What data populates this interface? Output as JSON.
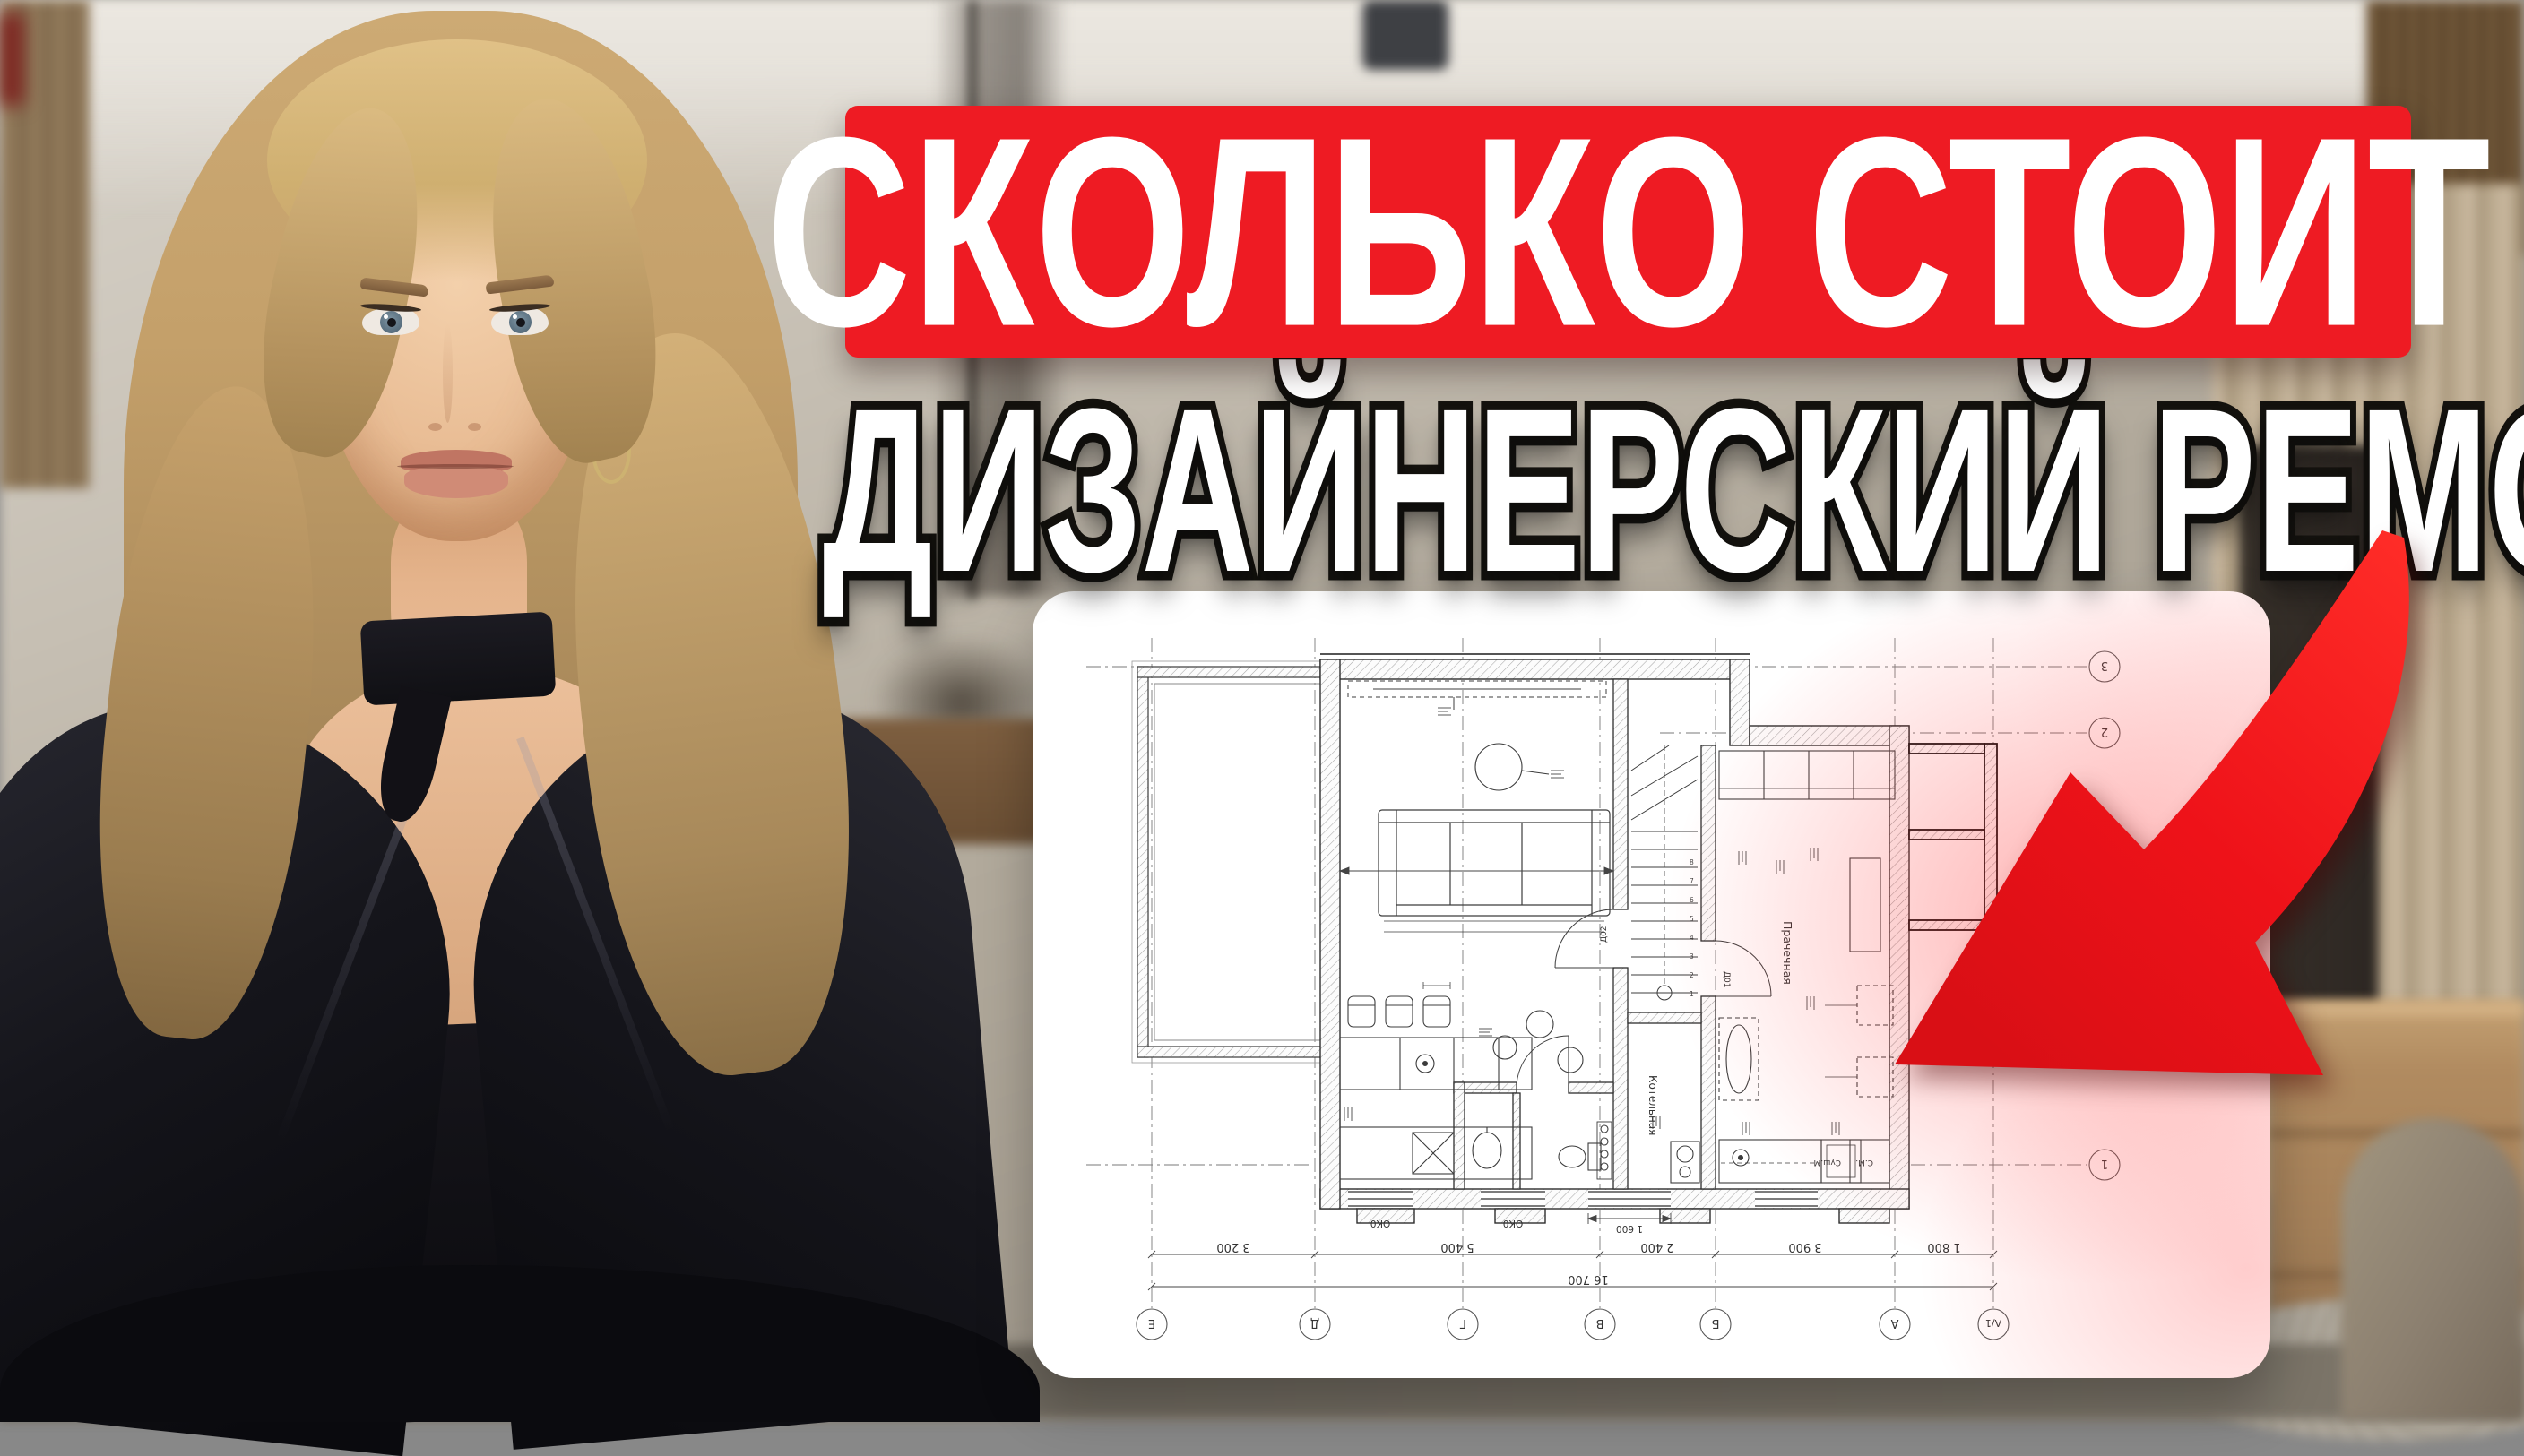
{
  "headline": {
    "line1": "СКОЛЬКО СТОИТ",
    "line2": "ДИЗАЙНЕРСКИЙ РЕМОНТ?",
    "banner_color": "#ee1b23",
    "text_color": "#ffffff",
    "outline_color": "#15130f"
  },
  "arrow": {
    "color": "#f01218"
  },
  "floor_plan": {
    "rooms": {
      "boiler": "Котельная",
      "laundry": "Прачечная"
    },
    "appliances": {
      "dryer": "Суш.М",
      "washer": "С.М."
    },
    "door_tags": {
      "d1": "Д01",
      "d2": "Д02"
    },
    "window_tag": "ОК0",
    "window_tag_2": "ОК0",
    "dimensions": {
      "seg_1": "3 200",
      "seg_2": "5 400",
      "seg_3": "2 400",
      "seg_4": "3 900",
      "seg_5": "1 800",
      "total": "16 700",
      "window": "1 600"
    },
    "axes_bottom": [
      "Е",
      "Д",
      "Г",
      "В",
      "Б",
      "А",
      "А/1"
    ],
    "axes_right": [
      "3",
      "2",
      "1"
    ],
    "stair_steps": [
      "1",
      "2",
      "3",
      "4",
      "5",
      "6",
      "7",
      "8"
    ]
  }
}
